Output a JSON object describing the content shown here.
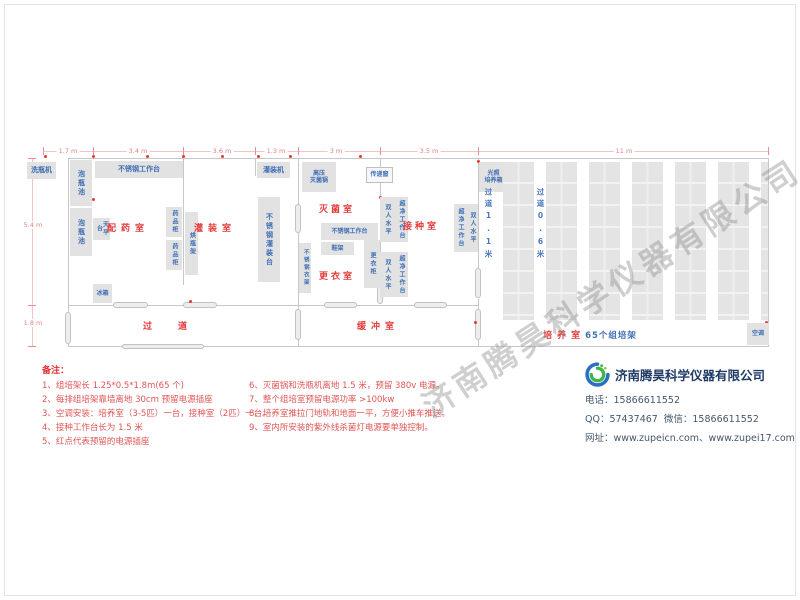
{
  "watermark": "济南腾昊科学仪器有限公司",
  "plan": {
    "walls": [
      [
        68,
        158,
        701,
        1
      ],
      [
        68,
        158,
        1,
        189
      ],
      [
        68,
        346,
        701,
        1
      ],
      [
        768,
        158,
        1,
        189
      ],
      [
        68,
        305,
        231,
        1
      ],
      [
        299,
        305,
        180,
        1
      ],
      [
        183,
        158,
        1,
        127
      ],
      [
        298,
        158,
        1,
        48
      ],
      [
        298,
        232,
        1,
        79
      ],
      [
        298,
        339,
        1,
        8
      ],
      [
        380,
        158,
        1,
        126
      ],
      [
        478,
        158,
        1,
        112
      ],
      [
        478,
        299,
        1,
        12
      ],
      [
        478,
        339,
        1,
        8
      ],
      [
        255,
        158,
        1,
        18
      ]
    ],
    "doors": [
      [
        113,
        302,
        35,
        6
      ],
      [
        183,
        302,
        34,
        6
      ],
      [
        324,
        302,
        33,
        6
      ],
      [
        414,
        302,
        33,
        6
      ],
      [
        122,
        344,
        82,
        5
      ],
      [
        65,
        312,
        6,
        32
      ],
      [
        295,
        309,
        6,
        31
      ],
      [
        475,
        309,
        6,
        31
      ],
      [
        475,
        268,
        6,
        30
      ],
      [
        377,
        282,
        6,
        22
      ],
      [
        295,
        204,
        6,
        29
      ]
    ],
    "outlets": [
      [
        44,
        155
      ],
      [
        92,
        155
      ],
      [
        146,
        155
      ],
      [
        182,
        155
      ],
      [
        221,
        155
      ],
      [
        257,
        155
      ],
      [
        289,
        155
      ],
      [
        359,
        155
      ],
      [
        477,
        160
      ],
      [
        92,
        198
      ],
      [
        189,
        300
      ],
      [
        379,
        196
      ],
      [
        474,
        206
      ],
      [
        474,
        321
      ],
      [
        765,
        321
      ]
    ],
    "dimlines": [
      [
        43,
        151,
        726,
        1
      ],
      [
        32,
        158,
        1,
        189
      ]
    ],
    "ticks": [
      [
        43,
        147,
        1,
        8
      ],
      [
        93,
        147,
        1,
        8
      ],
      [
        183,
        147,
        1,
        8
      ],
      [
        255,
        147,
        1,
        8
      ],
      [
        298,
        147,
        1,
        8
      ],
      [
        380,
        147,
        1,
        8
      ],
      [
        478,
        147,
        1,
        8
      ],
      [
        768,
        147,
        1,
        8
      ],
      [
        28,
        158,
        8,
        1
      ],
      [
        28,
        305,
        8,
        1
      ],
      [
        28,
        346,
        8,
        1
      ]
    ],
    "dims_top": [
      {
        "label": "1.7 m",
        "x": 68
      },
      {
        "label": "3.4 m",
        "x": 138
      },
      {
        "label": "3.6 m",
        "x": 222
      },
      {
        "label": "1.3 m",
        "x": 276
      },
      {
        "label": "3 m",
        "x": 336
      },
      {
        "label": "3.5 m",
        "x": 429
      },
      {
        "label": "11 m",
        "x": 624
      }
    ],
    "dims_left": [
      {
        "label": "5.4 m",
        "x": 33,
        "y": 225
      },
      {
        "label": "1.8 m",
        "x": 33,
        "y": 323
      }
    ],
    "equipment": [
      {
        "name": "bottle-washer",
        "label": "洗瓶机",
        "x": 27,
        "y": 162,
        "w": 29,
        "h": 17,
        "o": "h",
        "fs": 7
      },
      {
        "name": "bottle-soak-pool-1",
        "label": "泡瓶池",
        "x": 70,
        "y": 160,
        "w": 22,
        "h": 46,
        "o": "v",
        "fs": 7
      },
      {
        "name": "bottle-soak-pool-2",
        "label": "泡瓶池",
        "x": 70,
        "y": 208,
        "w": 22,
        "h": 48,
        "o": "v",
        "fs": 7
      },
      {
        "name": "steel-workbench-1",
        "label": "不锈钢工作台",
        "x": 95,
        "y": 161,
        "w": 88,
        "h": 17,
        "o": "h",
        "fs": 7
      },
      {
        "name": "balance-table",
        "label": "天平台",
        "x": 93,
        "y": 218,
        "w": 17,
        "h": 22,
        "o": "v",
        "fs": 6
      },
      {
        "name": "medicine-cabinet-1",
        "label": "药品柜",
        "x": 166,
        "y": 207,
        "w": 16,
        "h": 30,
        "o": "v",
        "fs": 6
      },
      {
        "name": "medicine-cabinet-2",
        "label": "药品柜",
        "x": 166,
        "y": 240,
        "w": 16,
        "h": 30,
        "o": "v",
        "fs": 6
      },
      {
        "name": "refrigerator",
        "label": "冰箱",
        "x": 93,
        "y": 284,
        "w": 19,
        "h": 19,
        "o": "h",
        "fs": 6
      },
      {
        "name": "bottle-drying-rack",
        "label": "烘瓶架",
        "x": 185,
        "y": 212,
        "w": 13,
        "h": 63,
        "o": "v",
        "fs": 6
      },
      {
        "name": "filling-machine",
        "label": "灌装机",
        "x": 257,
        "y": 162,
        "w": 33,
        "h": 16,
        "o": "h",
        "fs": 7
      },
      {
        "name": "steel-filling-table",
        "label": "不锈钢灌装台",
        "x": 258,
        "y": 197,
        "w": 22,
        "h": 85,
        "o": "v",
        "fs": 7
      },
      {
        "name": "autoclave",
        "label": "高压\n灭菌锅",
        "x": 302,
        "y": 162,
        "w": 34,
        "h": 30,
        "o": "h",
        "fs": 6
      },
      {
        "name": "transfer-window",
        "label": "传递窗",
        "x": 366,
        "y": 167,
        "w": 27,
        "h": 16,
        "o": "h",
        "fs": 6,
        "cls": "light"
      },
      {
        "name": "steel-workbench-2",
        "label": "不锈钢工作台",
        "x": 321,
        "y": 223,
        "w": 57,
        "h": 17,
        "o": "h",
        "fs": 6
      },
      {
        "name": "shoe-rack",
        "label": "鞋架",
        "x": 321,
        "y": 242,
        "w": 33,
        "h": 13,
        "o": "h",
        "fs": 6
      },
      {
        "name": "locker",
        "label": "更衣柜",
        "x": 364,
        "y": 240,
        "w": 16,
        "h": 48,
        "o": "v",
        "fs": 6
      },
      {
        "name": "steel-clothes-rack",
        "label": "不锈钢衣架",
        "x": 299,
        "y": 243,
        "w": 12,
        "h": 50,
        "o": "v",
        "fs": 5.5
      },
      {
        "name": "clean-bench-upper-a",
        "label": "双人水平",
        "x": 380,
        "y": 197,
        "w": 14,
        "h": 45,
        "o": "v",
        "fs": 6
      },
      {
        "name": "clean-bench-upper-b",
        "label": "超净工作台",
        "x": 394,
        "y": 197,
        "w": 14,
        "h": 45,
        "o": "v",
        "fs": 6
      },
      {
        "name": "clean-bench-lower-a",
        "label": "双人水平",
        "x": 380,
        "y": 252,
        "w": 14,
        "h": 45,
        "o": "v",
        "fs": 6
      },
      {
        "name": "clean-bench-lower-b",
        "label": "超净工作台",
        "x": 394,
        "y": 252,
        "w": 14,
        "h": 45,
        "o": "v",
        "fs": 6
      },
      {
        "name": "clean-bench-right-a",
        "label": "超净工作台",
        "x": 454,
        "y": 204,
        "w": 12,
        "h": 48,
        "o": "v",
        "fs": 6
      },
      {
        "name": "clean-bench-right-b",
        "label": "双人水平",
        "x": 466,
        "y": 204,
        "w": 12,
        "h": 48,
        "o": "v",
        "fs": 6
      },
      {
        "name": "light-incubator",
        "label": "光照\n培养箱",
        "x": 479,
        "y": 162,
        "w": 29,
        "h": 30,
        "o": "h",
        "fs": 6
      },
      {
        "name": "air-conditioner",
        "label": "空调",
        "x": 747,
        "y": 323,
        "w": 22,
        "h": 22,
        "o": "h",
        "fs": 6
      }
    ],
    "rooms": [
      {
        "name": "room-label-dispensing",
        "label": "配药室",
        "x": 93,
        "y": 221,
        "w": 70,
        "ls": 5
      },
      {
        "name": "room-label-filling",
        "label": "灌装室",
        "x": 180,
        "y": 221,
        "w": 70,
        "ls": 5
      },
      {
        "name": "room-label-sterilization",
        "label": "灭菌室",
        "x": 302,
        "y": 202,
        "w": 70,
        "ls": 3
      },
      {
        "name": "room-label-inoculation",
        "label": "接种室",
        "x": 386,
        "y": 219,
        "w": 70,
        "ls": 3
      },
      {
        "name": "room-label-changing",
        "label": "更衣室",
        "x": 302,
        "y": 269,
        "w": 70,
        "ls": 3
      },
      {
        "name": "room-label-aisle",
        "label": "过道",
        "x": 138,
        "y": 319,
        "w": 80,
        "ls": 26
      },
      {
        "name": "room-label-buffer",
        "label": "缓冲室",
        "x": 340,
        "y": 319,
        "w": 76,
        "ls": 5
      }
    ],
    "culture_room_label": {
      "red": "培养室",
      "blue": "65个组培架",
      "x": 510,
      "y": 328,
      "w": 160,
      "ls": 5
    },
    "aisles": [
      {
        "name": "aisle-label-1-1m",
        "label": "过道1.1米",
        "x": 483,
        "y": 188,
        "h": 76
      },
      {
        "name": "aisle-label-0-6m",
        "label": "过道0.6米",
        "x": 535,
        "y": 188,
        "h": 76
      }
    ],
    "racks": {
      "x0": 503,
      "y0": 162,
      "w": 31,
      "h": 158,
      "count": 7,
      "pitch": 43,
      "clip": 768
    }
  },
  "notes": {
    "title": "备注：",
    "left": [
      "1、组培架长 1.25*0.5*1.8m(65 个)",
      "2、每排组培架靠墙离地 30cm 预留电源插座",
      "3、空调安装：培养室（3-5匹）一台，接种室（2匹）一台。",
      "4、接种工作台长为 1.5 米",
      "5、红点代表预留的电源插座"
    ],
    "right": [
      "6、灭菌锅和洗瓶机离地 1.5 米，预留 380v 电源。",
      "7、整个组培室预留电源功率 >100kw",
      "8、培养室推拉门地轨和地面一平，方便小推车推送。",
      "9、室内所安装的紫外线杀菌灯电源要单独控制。"
    ]
  },
  "company": {
    "name": "济南腾昊科学仪器有限公司",
    "phone_label": "电话：",
    "phone": "15866611552",
    "qq_label": "QQ：",
    "qq": "57437467",
    "wechat_label": "微信：",
    "wechat": "15866611552",
    "web_label": "网址：",
    "web": "www.zupeicn.com、www.zupei17.com"
  },
  "colors": {
    "room_label": "#e23b3b",
    "equipment_text": "#3f6fb5",
    "equipment_fill": "#e2e2e2",
    "dimension": "#e58080",
    "outlet_dot": "#e03a3a",
    "company_name": "#1f3b66"
  }
}
